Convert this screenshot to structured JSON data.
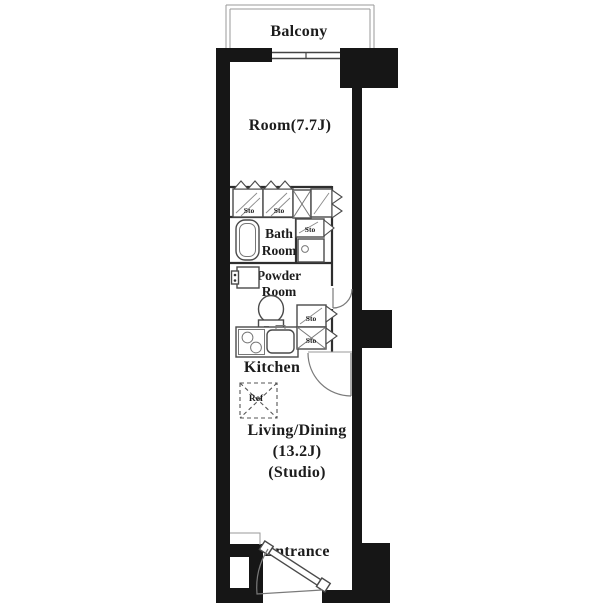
{
  "meta": {
    "type": "apartment-floor-plan"
  },
  "colors": {
    "background": "#ffffff",
    "wall": "#161616",
    "partition": "#2e2e2e",
    "fixture_line": "#4a4a4a",
    "text": "#1c1c1c"
  },
  "labels": {
    "balcony": "Balcony",
    "room": "Room(7.7J)",
    "bath_line1": "Bath",
    "bath_line2": "Room",
    "powder_line1": "Powder",
    "powder_line2": "Room",
    "kitchen": "Kitchen",
    "living_line1": "Living/Dining",
    "living_line2": "(13.2J)",
    "living_line3": "(Studio)",
    "entrance": "Entrance",
    "storage": "Sto",
    "refrigerator": "Ref"
  }
}
